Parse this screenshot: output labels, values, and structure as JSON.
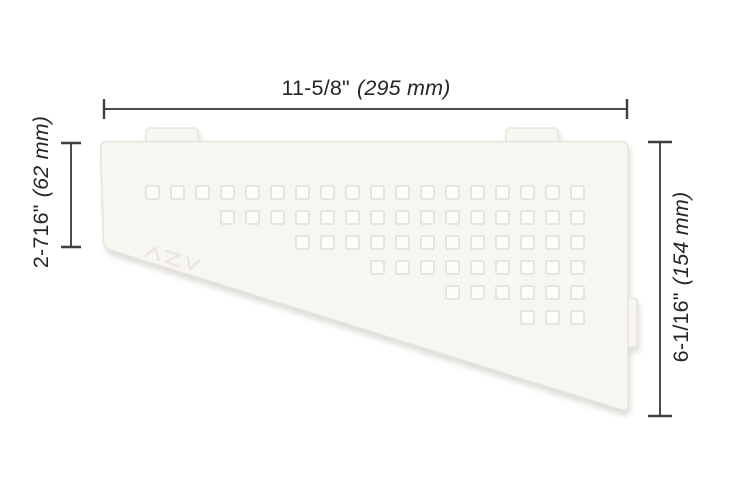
{
  "diagram": {
    "type": "product-dimension-drawing",
    "subject": "quadrilateral corner shelf with square perforation pattern"
  },
  "dimensions": {
    "top": {
      "inches": "11-5/8\"",
      "metric": "(295 mm)"
    },
    "left": {
      "inches": "2-716\"",
      "metric": "(62 mm)"
    },
    "right": {
      "inches": "6-1/16\"",
      "metric": "(154 mm)"
    }
  },
  "colors": {
    "background": "#ffffff",
    "shelf_fill": "#f7f6f1",
    "shelf_edge": "#e6e3db",
    "square_fill": "#fcfcfa",
    "square_edge": "#e2dfd8",
    "emboss": "#eae7e0",
    "dimension_line": "#4c4c4c",
    "dimension_tick": "#3e3e3e",
    "dimension_text": "#262626",
    "shadow": "rgba(184,179,168,0.45)"
  },
  "perforation_grid": {
    "square_size": 13,
    "col_pitch": 25,
    "row_pitch": 25,
    "origin": {
      "x": 146,
      "y": 186
    },
    "total_columns": 18,
    "rows": [
      {
        "start_col": 0,
        "count": 18
      },
      {
        "start_col": 3,
        "count": 15
      },
      {
        "start_col": 6,
        "count": 12
      },
      {
        "start_col": 9,
        "count": 9
      },
      {
        "start_col": 12,
        "count": 6
      },
      {
        "start_col": 15,
        "count": 3
      }
    ]
  }
}
